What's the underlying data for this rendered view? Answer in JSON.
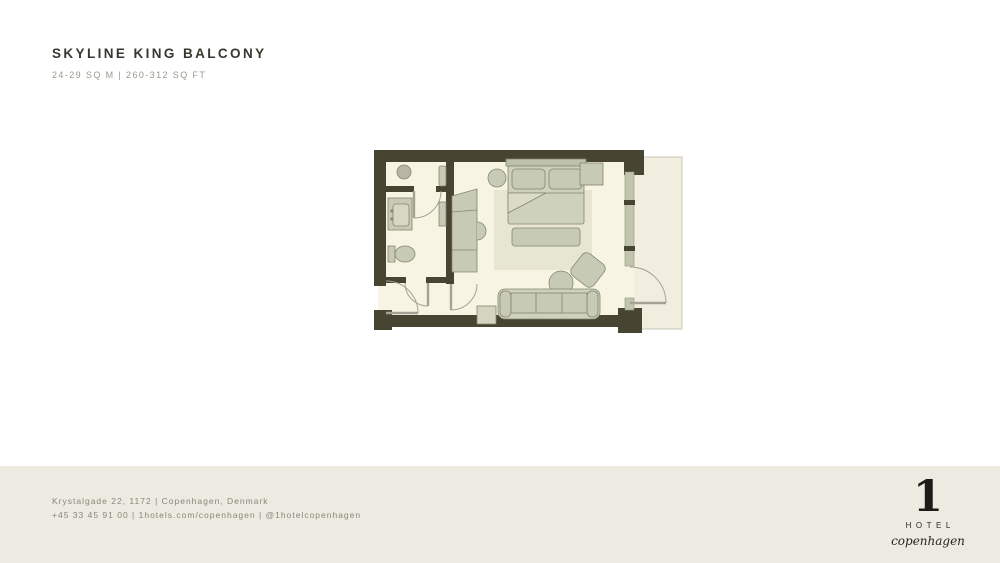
{
  "header": {
    "title": "SKYLINE KING BALCONY",
    "subtitle": "24-29 SQ M | 260-312 SQ FT"
  },
  "floorplan": {
    "palette": {
      "wall": "#474431",
      "floor": "#f7f4e4",
      "rug": "#e7e6d1",
      "furniture": "#c7cab4",
      "furniture_light": "#ced1bb",
      "outline": "#84876e",
      "balcony": "#f1eee0",
      "glass_wall": "#c2c5ae",
      "door_swing": "#a5a294"
    },
    "regions": [
      "bathroom",
      "entry-hall",
      "wardrobe-corridor",
      "bedroom",
      "balcony"
    ],
    "furniture_icons": [
      "shower-drain",
      "vanity-sink",
      "toilet",
      "closet-niche",
      "hall-shelf",
      "wardrobe",
      "king-bed",
      "pillows",
      "duvet-fold",
      "bed-bench",
      "round-side-table",
      "nightstand",
      "rug",
      "armchair",
      "ottoman",
      "sofa",
      "sofa-side-table"
    ],
    "door_icons": [
      "entry-door",
      "bathroom-door",
      "shower-door",
      "corridor-door",
      "balcony-door"
    ]
  },
  "footer": {
    "address": "Krystalgade 22, 1172 | Copenhagen, Denmark",
    "contact": "+45 33 45 91 00 | 1hotels.com/copenhagen | @1hotelcopenhagen",
    "logo": {
      "numeral": "1",
      "word": "HOTEL",
      "script": "copenhagen"
    }
  }
}
